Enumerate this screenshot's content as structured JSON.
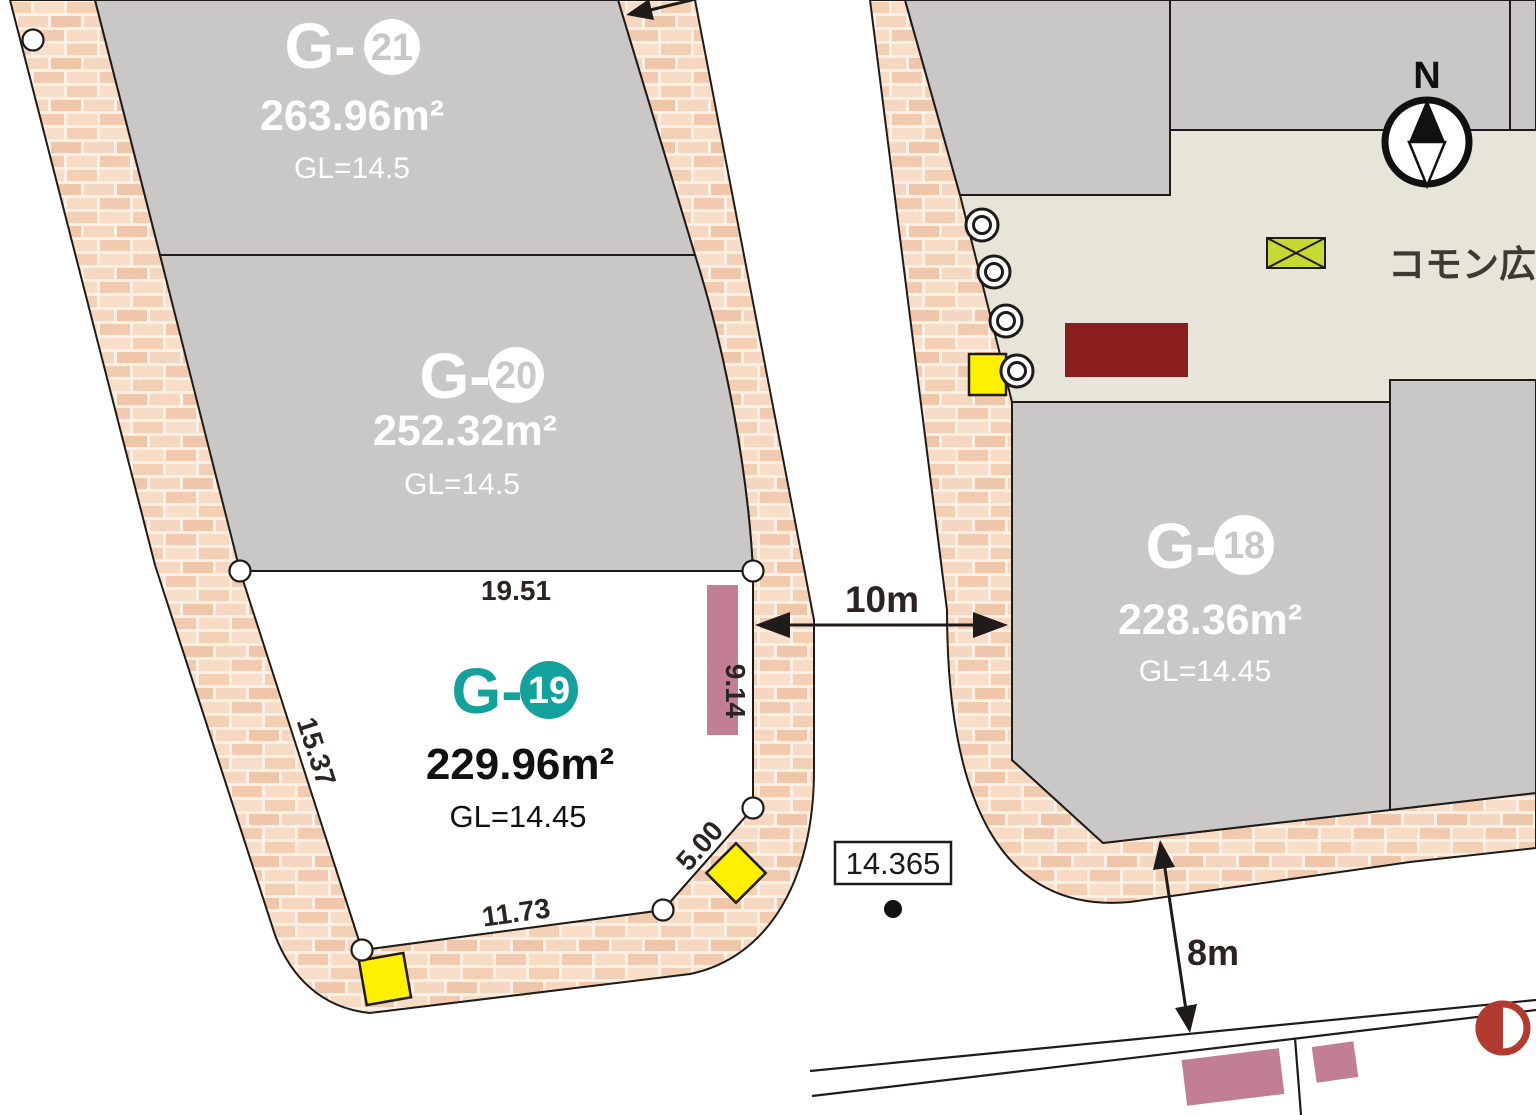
{
  "map": {
    "compass_label": "N",
    "plaza_label": "コモン広場",
    "lots": [
      {
        "label": "G-",
        "number": "21",
        "area": "263.96",
        "area_unit": "m²",
        "gl": "GL=14.5"
      },
      {
        "label": "G-",
        "number": "20",
        "area": "252.32",
        "area_unit": "m²",
        "gl": "GL=14.5"
      },
      {
        "label": "G-",
        "number": "19",
        "area": "229.96",
        "area_unit": "m²",
        "gl": "GL=14.45"
      },
      {
        "label": "G-",
        "number": "18",
        "area": "228.36",
        "area_unit": "m²",
        "gl": "GL=14.45"
      }
    ],
    "dimensions": {
      "lot19_top": "19.51",
      "lot19_left": "15.37",
      "lot19_bottom": "11.73",
      "lot19_corner": "5.00",
      "lot19_right": "9.14",
      "road_width": "10m",
      "setback": "8m",
      "benchmark_elevation": "14.365"
    },
    "symbols": {
      "compass": "north-compass",
      "survey_point": "black-dot",
      "vertex_marker": "white-circle",
      "tree_marker": "double-circle",
      "utility_box": "yellow-square",
      "planting_bed": "crossed-rectangle"
    },
    "colors": {
      "accent_teal": "#12a29b",
      "lot_gray": "#c9c8c7",
      "plaza_beige": "#e7e5d9",
      "brick_base": "#fbf0e6",
      "mauve": "#c17e95",
      "dark_red": "#8a1d1e",
      "signal_red": "#b23a2f",
      "yellow": "#ffef00",
      "yellow_green": "#c6d832",
      "line_black": "#1f1b18"
    }
  }
}
